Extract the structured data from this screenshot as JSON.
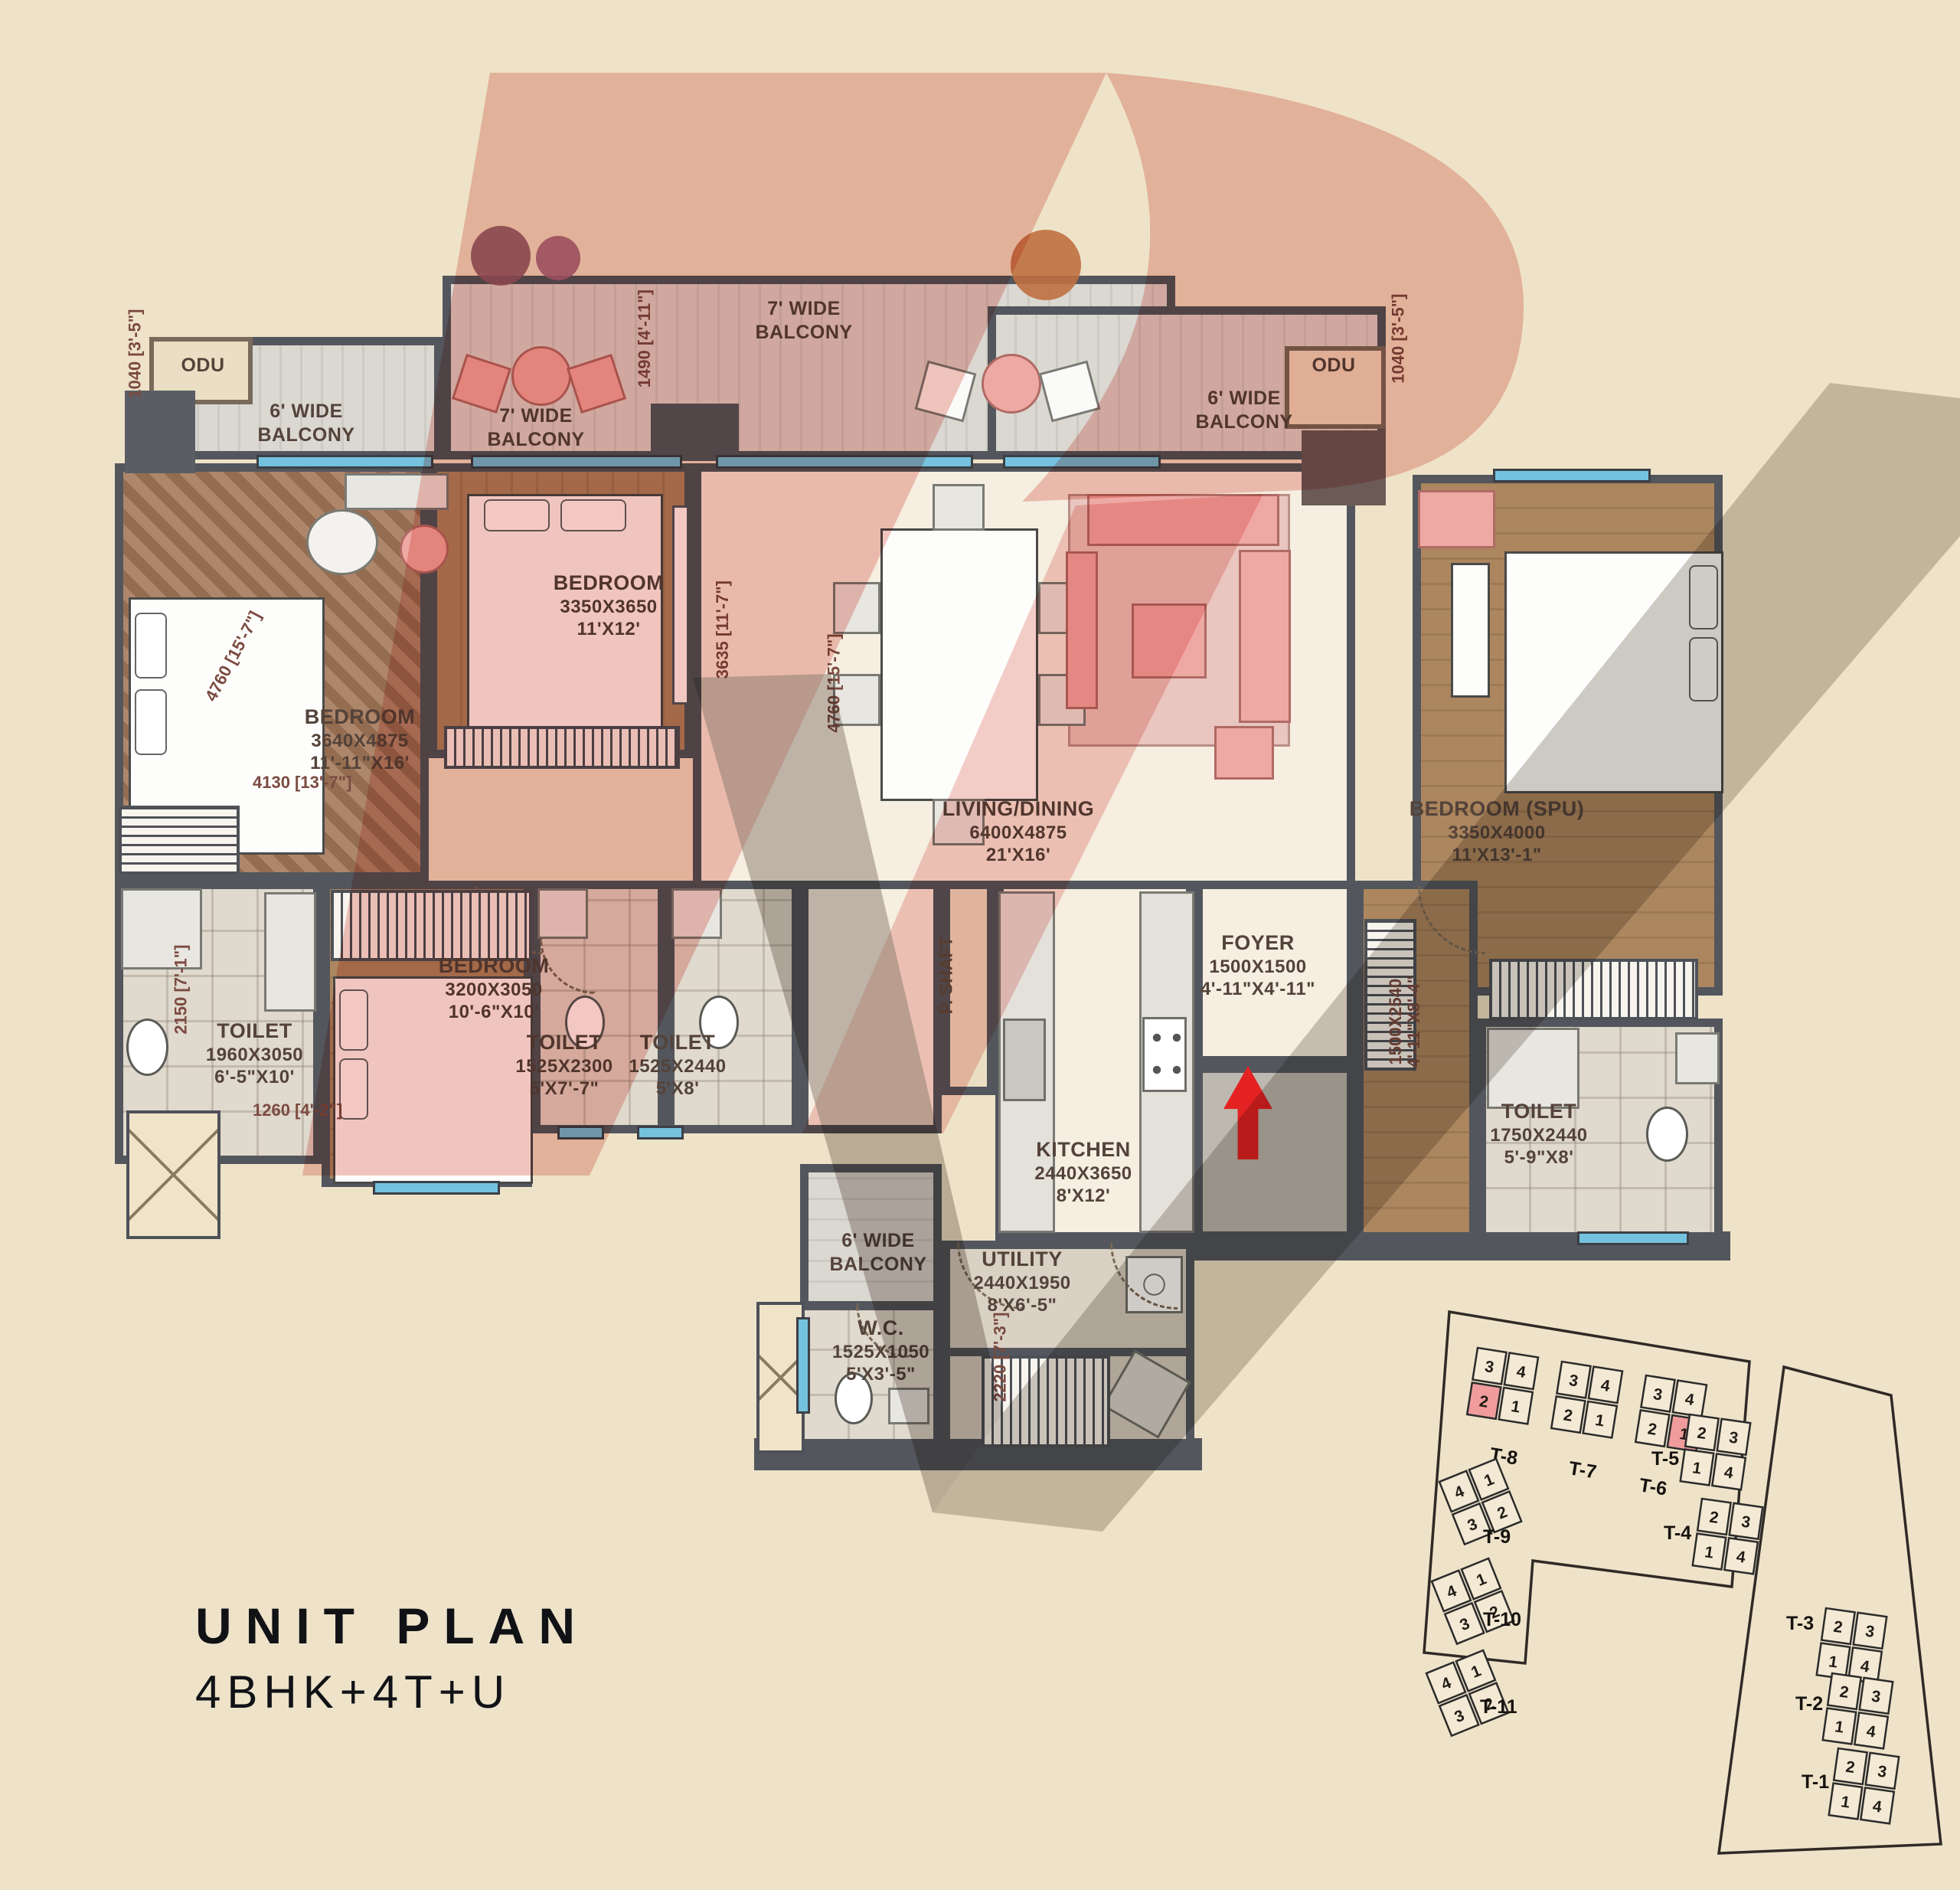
{
  "title": {
    "line1": "UNIT PLAN",
    "line2": "4BHK+4T+U"
  },
  "colors": {
    "background": "#EEE3C9",
    "wall": "#53565C",
    "accent_pink": "#E8938B",
    "keyplan_highlight": "#F09C9C",
    "entry_arrow": "#E42222",
    "window": "#74C2DE"
  },
  "plan": {
    "balconies": {
      "top": "7' WIDE BALCONY",
      "mid": "7' WIDE BALCONY",
      "left": "6' WIDE BALCONY",
      "right": "6' WIDE BALCONY",
      "bottom": "6' WIDE BALCONY"
    },
    "odu_left": "ODU",
    "odu_right": "ODU",
    "pshaft": "P. SHAFT",
    "rooms": {
      "bedroom1": {
        "name": "BEDROOM",
        "mm": "3640X4875",
        "ft": "11'-11\"X16'"
      },
      "bedroom2": {
        "name": "BEDROOM",
        "mm": "3350X3650",
        "ft": "11'X12'"
      },
      "living": {
        "name": "LIVING/DINING",
        "mm": "6400X4875",
        "ft": "21'X16'"
      },
      "spu": {
        "name": "BEDROOM (SPU)",
        "mm": "3350X4000",
        "ft": "11'X13'-1\""
      },
      "bedroom3": {
        "name": "BEDROOM",
        "mm": "3200X3050",
        "ft": "10'-6\"X10'"
      },
      "toilet1": {
        "name": "TOILET",
        "mm": "1960X3050",
        "ft": "6'-5\"X10'"
      },
      "toilet2": {
        "name": "TOILET",
        "mm": "1525X2300",
        "ft": "5'X7'-7\""
      },
      "toilet3": {
        "name": "TOILET",
        "mm": "1525X2440",
        "ft": "5'X8'"
      },
      "toilet_spu": {
        "name": "TOILET",
        "mm": "1750X2440",
        "ft": "5'-9\"X8'"
      },
      "kitchen": {
        "name": "KITCHEN",
        "mm": "2440X3650",
        "ft": "8'X12'"
      },
      "utility": {
        "name": "UTILITY",
        "mm": "2440X1950",
        "ft": "8'X6'-5\""
      },
      "wc": {
        "name": "W.C.",
        "mm": "1525X1050",
        "ft": "5'X3'-5\""
      },
      "foyer": {
        "name": "FOYER",
        "mm": "1500X1500",
        "ft": "4'-11\"X4'-11\""
      }
    },
    "dims": {
      "odu_left": "1040 [3'-5\"]",
      "odu_right": "1040 [3'-5\"]",
      "balcony_top": "1490 [4'-11\"]",
      "bedroom1_diag": "4760 [15'-7\"]",
      "bedroom1_w": "4130 [13'-7\"]",
      "bedroom2_h": "3635 [11'-7\"]",
      "living_h": "4760 [15'-7\"]",
      "toilet1_h": "2150 [7'-1\"]",
      "toilet1_w": "1260 [4'-2\"]",
      "stair": "2220 [7'-3\"]",
      "spu_corridor_mm": "1500X2540",
      "spu_corridor_ft": "4'-11\"X8'-4\""
    }
  },
  "keyplan": {
    "towers": [
      {
        "label": "T-8",
        "units": [
          "3",
          "4",
          "2",
          "1"
        ],
        "highlight": "2"
      },
      {
        "label": "T-7",
        "units": [
          "3",
          "4",
          "2",
          "1"
        ]
      },
      {
        "label": "T-6",
        "units": [
          "3",
          "4",
          "2",
          "1"
        ],
        "highlight": "1"
      },
      {
        "label": "T-5",
        "units": [
          "2",
          "3",
          "1",
          "4"
        ]
      },
      {
        "label": "T-4",
        "units": [
          "2",
          "3",
          "1",
          "4"
        ]
      },
      {
        "label": "T-3",
        "units": [
          "2",
          "3",
          "1",
          "4"
        ]
      },
      {
        "label": "T-2",
        "units": [
          "2",
          "3",
          "1",
          "4"
        ]
      },
      {
        "label": "T-1",
        "units": [
          "2",
          "3",
          "1",
          "4"
        ]
      },
      {
        "label": "T-9",
        "units": [
          "4",
          "1",
          "3",
          "2"
        ]
      },
      {
        "label": "T-10",
        "units": [
          "4",
          "1",
          "3",
          "2"
        ]
      },
      {
        "label": "T-11",
        "units": [
          "4",
          "1",
          "3",
          "2"
        ]
      }
    ]
  }
}
